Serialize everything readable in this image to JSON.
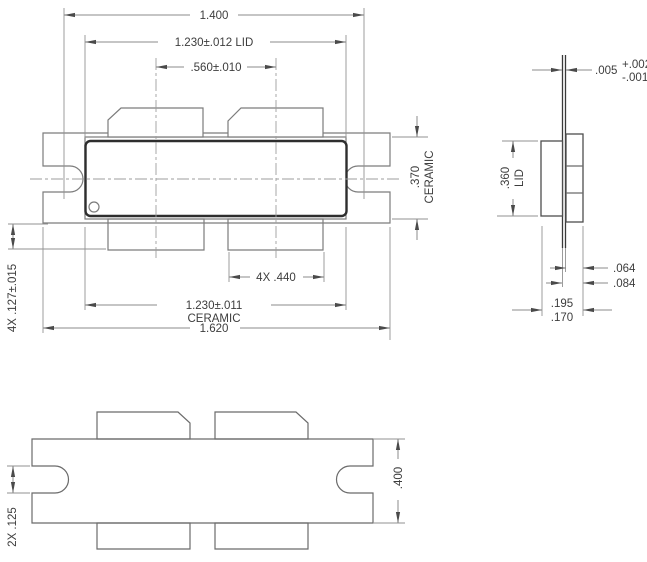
{
  "views": {
    "top": {
      "hole_span": "1.400",
      "lid_width": "1.230±.012 LID",
      "lead_pitch": ".560±.010",
      "ceramic_depth": ".370",
      "ceramic_depth_label": "CERAMIC",
      "lead_width": "4X .440",
      "ceramic_width": "1.230±.011",
      "ceramic_width_label": "CERAMIC",
      "flange_length": "1.620",
      "lead_length": "4X .127±.015"
    },
    "side": {
      "lead_thickness": ".005",
      "lead_thickness_tol_plus": "+.002",
      "lead_thickness_tol_minus": "-.001",
      "lid_span": ".360",
      "lid_span_label": "LID",
      "flange_thickness": ".064",
      "seat_height": ".084",
      "height_max": ".195",
      "height_min": ".170"
    },
    "bottom": {
      "slot_width": "2X .125",
      "flange_width": ".400"
    }
  }
}
